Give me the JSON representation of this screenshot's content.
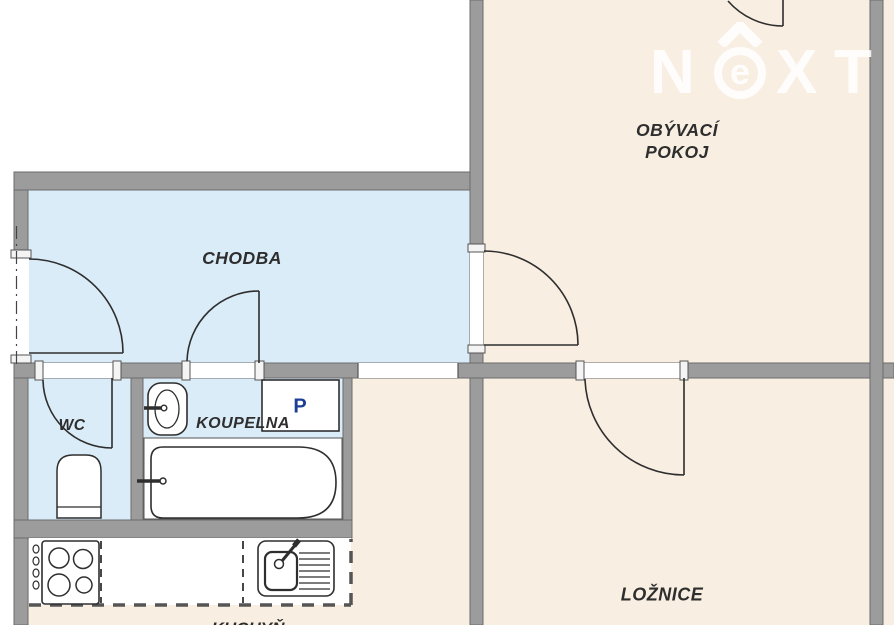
{
  "plan_title": "Apartment floor plan",
  "rooms": [
    {
      "id": "living-room",
      "label": "OBÝVACÍ POKOJ",
      "label_line1": "OBÝVACÍ",
      "label_line2": "POKOJ"
    },
    {
      "id": "hallway",
      "label": "CHODBA"
    },
    {
      "id": "wc",
      "label": "WC"
    },
    {
      "id": "bathroom",
      "label": "KOUPELNA"
    },
    {
      "id": "bedroom",
      "label": "LOŽNICE"
    },
    {
      "id": "kitchen",
      "label": "KUCHYŇ"
    }
  ],
  "fixtures": {
    "washing_machine_label": "P"
  },
  "watermark": {
    "text": "NeXT",
    "part_n": "N",
    "part_e": "e",
    "part_x": "X",
    "part_t": "T"
  },
  "colors": {
    "room_cream": "#f8eee2",
    "room_blue": "#daecf8",
    "wall_fill": "#9c9c9c",
    "wall_edge": "#6b6b6b",
    "line_ink": "#2e2e2e",
    "label_ink": "#141414",
    "washer_navy": "#1c3f94",
    "watermark_white": "#ffffff"
  }
}
